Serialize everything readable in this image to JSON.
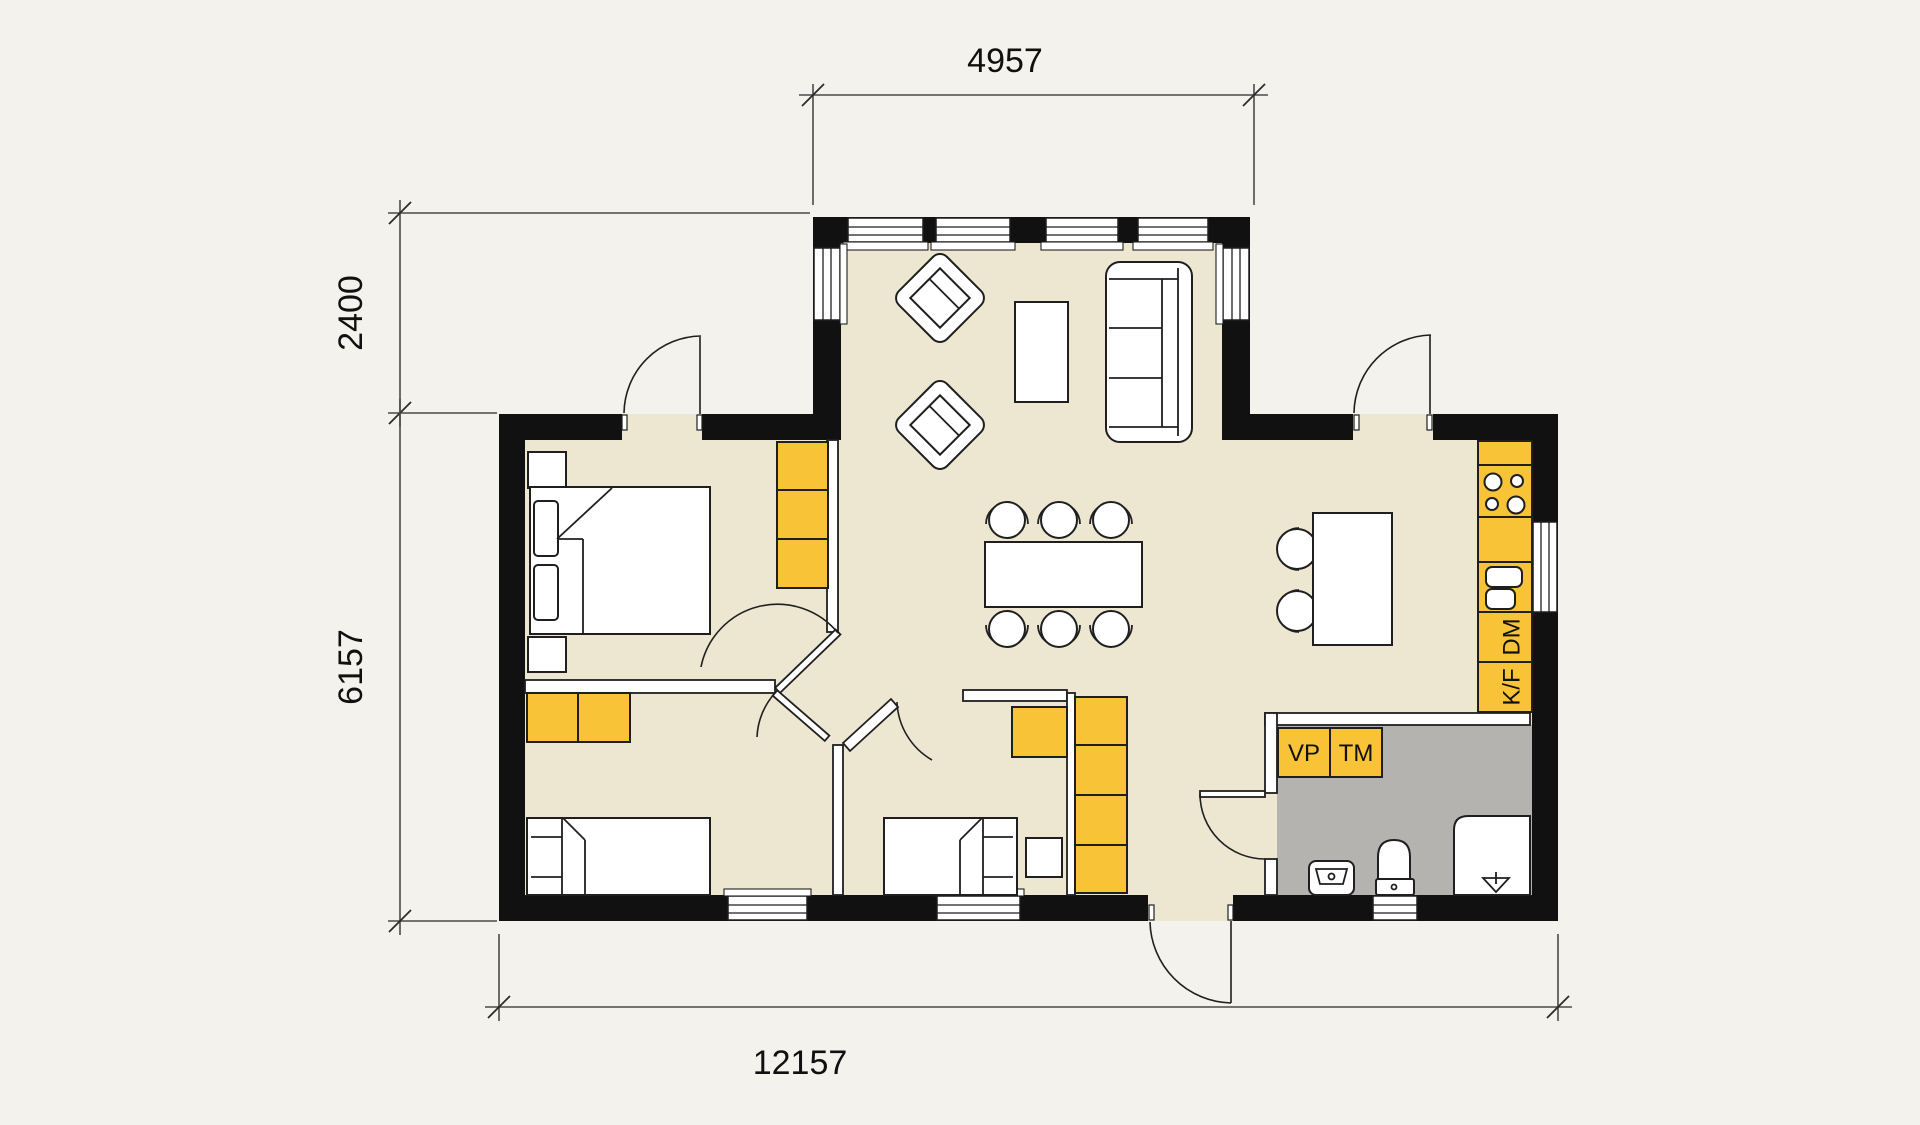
{
  "drawing": {
    "type": "architectural-floor-plan",
    "dimension_labels": {
      "top_width": "4957",
      "left_upper_height": "2400",
      "left_lower_height": "6157",
      "bottom_width": "12157"
    },
    "appliance_labels": {
      "heat_pump": "VP",
      "washing_machine": "TM",
      "dishwasher": "DM",
      "fridge_freezer": "K/F"
    },
    "rooms": [
      {
        "name": "living-room",
        "furniture": [
          "armchair",
          "armchair",
          "coffee-table",
          "sofa"
        ]
      },
      {
        "name": "dining-area",
        "furniture": [
          "dining-table",
          "six-chairs"
        ]
      },
      {
        "name": "kitchen",
        "furniture": [
          "island-counter",
          "two-bar-chairs",
          "stove",
          "sink",
          "dishwasher",
          "fridge-freezer"
        ]
      },
      {
        "name": "master-bedroom",
        "furniture": [
          "double-bed",
          "two-nightstands",
          "wardrobe"
        ]
      },
      {
        "name": "bedroom-2",
        "furniture": [
          "single-bed",
          "wardrobe"
        ]
      },
      {
        "name": "bedroom-3",
        "furniture": [
          "single-bed",
          "dresser",
          "nightstand"
        ]
      },
      {
        "name": "bathroom",
        "furniture": [
          "washbasin",
          "toilet",
          "shower",
          "heat-pump",
          "washing-machine"
        ]
      },
      {
        "name": "hall",
        "furniture": [
          "wardrobe-column"
        ]
      }
    ],
    "colors": {
      "background": "#F4F2EC",
      "floor": "#EDE7D2",
      "wall": "#111111",
      "accent_yellow": "#F9C338",
      "wet_room_gray": "#B5B3B0",
      "line": "#1F1F1F",
      "dimension_line": "#4A4A4A"
    }
  }
}
